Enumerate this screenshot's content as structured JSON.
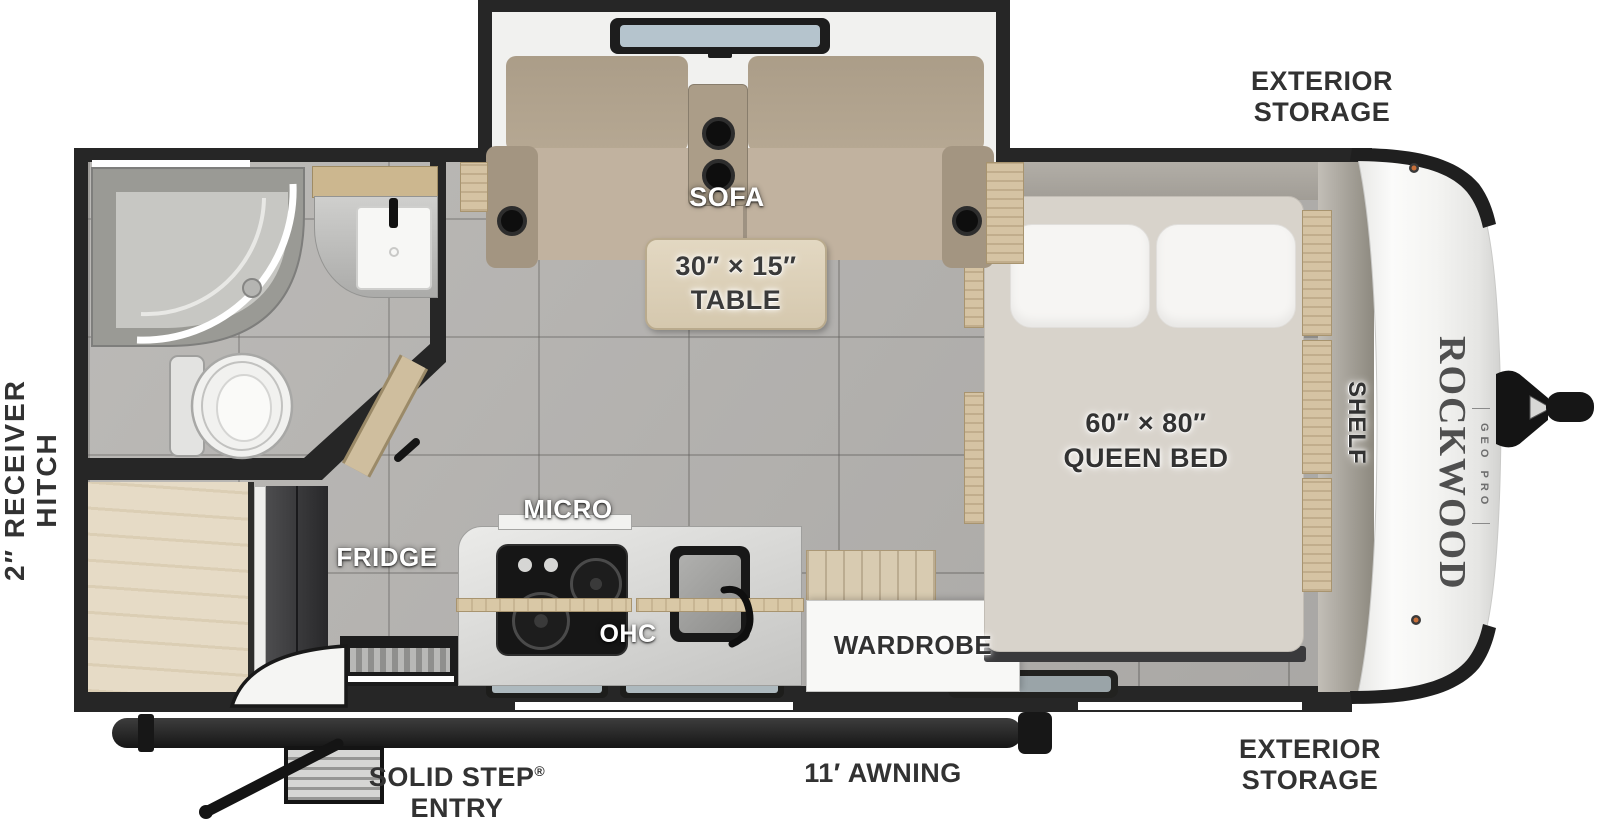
{
  "title": "Travel trailer floor plan",
  "brand": {
    "name": "ROCKWOOD",
    "sub": "GEO PRO"
  },
  "exterior_labels": {
    "hitch": [
      "2″ RECEIVER",
      "HITCH"
    ],
    "storage_top": [
      "EXTERIOR",
      "STORAGE"
    ],
    "storage_bottom": [
      "EXTERIOR",
      "STORAGE"
    ],
    "awning": "11′ AWNING",
    "entry_step": "SOLID STEP",
    "entry_step_reg": "®",
    "entry": "ENTRY"
  },
  "room_labels": {
    "sofa": "SOFA",
    "table": [
      "30″ × 15″",
      "TABLE"
    ],
    "micro": "MICRO",
    "fridge": "FRIDGE",
    "ohc": "OHC",
    "wardrobe": "WARDROBE",
    "bed": [
      "60″ × 80″",
      "QUEEN BED"
    ],
    "shelf": "SHELF"
  },
  "colors": {
    "wall": "#262626",
    "floor_tile": "#b4b2af",
    "wood": "#d5c3a3",
    "sofa_fabric": "#b2a48f",
    "mattress": "#d8d3cb",
    "front_cap": "#f5f5f3",
    "label_dark": "#323232",
    "label_light": "#ffffff"
  }
}
